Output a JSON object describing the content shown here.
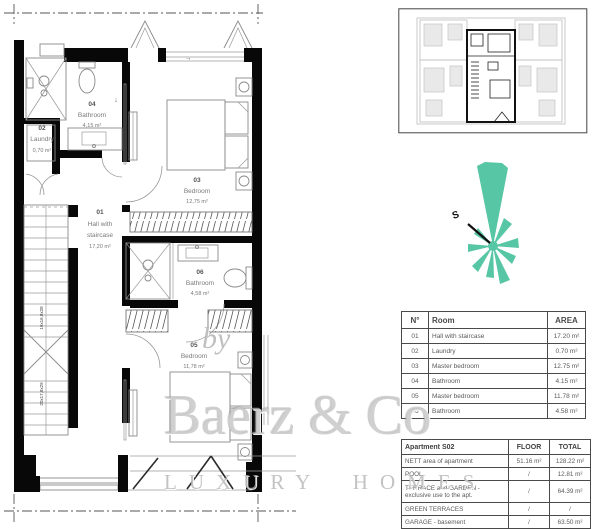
{
  "plan": {
    "rooms": [
      {
        "num": "01",
        "line1": "Hall with",
        "line2": "staircase",
        "area": "17,20 m²"
      },
      {
        "num": "02",
        "line1": "Laundry",
        "line2": "",
        "area": "0,70 m²"
      },
      {
        "num": "03",
        "line1": "Bedroom",
        "line2": "",
        "area": "12,75 m²"
      },
      {
        "num": "04",
        "line1": "Bathroom",
        "line2": "",
        "area": "4,15 m²"
      },
      {
        "num": "05",
        "line1": "Bedroom",
        "line2": "",
        "area": "11,78 m²"
      },
      {
        "num": "06",
        "line1": "Bathroom",
        "line2": "",
        "area": "4,58 m²"
      }
    ],
    "stair_labels": [
      "19x16,8x28",
      "20x17,8x29"
    ],
    "arrow_down": "↓",
    "arrow_right": "→"
  },
  "compass": {
    "letter": "S",
    "color": "#57C6A4"
  },
  "room_table": {
    "headers": {
      "no": "N°",
      "room": "Room",
      "area": "AREA"
    },
    "rows": [
      {
        "no": "01",
        "room": "Hall with staircase",
        "area": "17.20 m²"
      },
      {
        "no": "02",
        "room": "Laundry",
        "area": "0.70 m²"
      },
      {
        "no": "03",
        "room": "Master bedroom",
        "area": "12.75 m²"
      },
      {
        "no": "04",
        "room": "Bathroom",
        "area": "4.15 m²"
      },
      {
        "no": "05",
        "room": "Master bedroom",
        "area": "11.78 m²"
      },
      {
        "no": "06",
        "room": "Bathroom",
        "area": "4.58 m²"
      }
    ]
  },
  "summary_table": {
    "title": "Apartment S02",
    "col_floor": "FLOOR",
    "col_total": "TOTAL",
    "rows": [
      {
        "label": "NETT area of apartment",
        "floor": "51.16 m²",
        "total": "128.22 m²"
      },
      {
        "label": "POOL",
        "floor": "/",
        "total": "12.81 m²"
      },
      {
        "label": "TERRACE and GARDEN - exclusive use to the apt.",
        "floor": "/",
        "total": "64.39 m²"
      },
      {
        "label": "GREEN TERRACES",
        "floor": "/",
        "total": "/"
      },
      {
        "label": "GARAGE - basement",
        "floor": "/",
        "total": "63.50 m²"
      }
    ]
  },
  "watermark": {
    "by": "by",
    "brand": "Baerz & Co",
    "tagline": "LUXURY HOMES"
  }
}
